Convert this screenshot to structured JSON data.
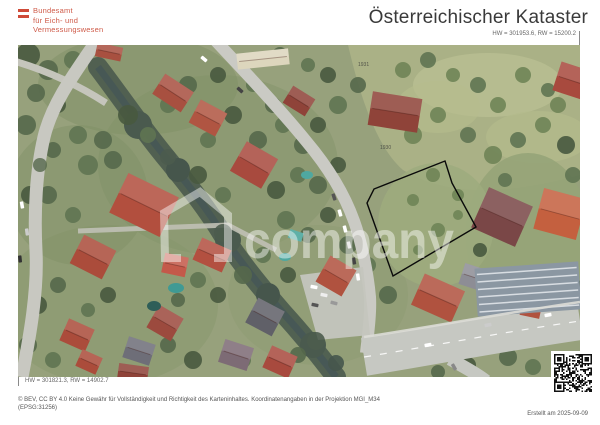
{
  "page": {
    "title": "Österreichischer Kataster"
  },
  "agency": {
    "name_lines": [
      "Bundesamt",
      "für Eich- und",
      "Vermessungswesen"
    ],
    "flag_icon": "austrian-flag",
    "brand_color": "#cf5b49"
  },
  "map": {
    "coord_top_right": "HW = 301953.6, RW = 15200.2",
    "coord_bottom_left": "HW = 301821.3, RW = 14902.7",
    "watermark_text": "company",
    "parcel_numbers": {
      "upper": "1931",
      "lower": "1930"
    },
    "parcel_outline_color": "#0a0a0a"
  },
  "footer": {
    "license_line1": "© BEV, CC BY 4.0 Keine Gewähr für Vollständigkeit und Richtigkeit des Karteninhaltes. Koordinatenangaben in der Projektion  MGI_M34",
    "license_line2": "(EPSG:31256)",
    "created": "Erstellt am 2025-09-09"
  }
}
